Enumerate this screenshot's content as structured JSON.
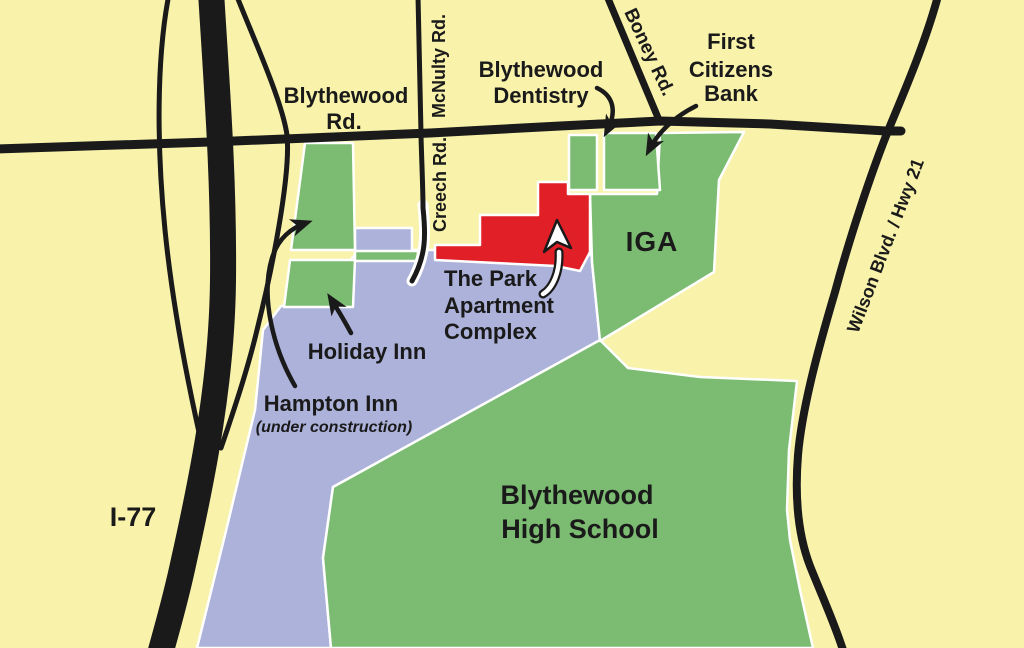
{
  "map": {
    "colors": {
      "background": "#F8F2AB",
      "parcel_green": "#7CBC72",
      "apartment_blue": "#ACB2D9",
      "highlight_red": "#E11F26",
      "road_black": "#1A1A1A",
      "outline_white": "#FFFFFF"
    },
    "roads": {
      "i77": "I-77",
      "blythewood_rd_line1": "Blythewood",
      "blythewood_rd_line2": "Rd.",
      "mcnulty_rd": "McNulty Rd.",
      "creech_rd": "Creech Rd.",
      "boney_rd": "Boney Rd.",
      "wilson_blvd": "Wilson Blvd. / Hwy 21"
    },
    "places": {
      "dentistry_line1": "Blythewood",
      "dentistry_line2": "Dentistry",
      "first_citizens_line1": "First",
      "first_citizens_line2": "Citizens",
      "first_citizens_line3": "Bank",
      "iga": "IGA",
      "park_line1": "The Park",
      "park_line2": "Apartment",
      "park_line3": "Complex",
      "holiday_inn": "Holiday Inn",
      "hampton_inn_line1": "Hampton Inn",
      "hampton_inn_line2": "(under construction)",
      "high_school_line1": "Blythewood",
      "high_school_line2": "High School"
    }
  }
}
